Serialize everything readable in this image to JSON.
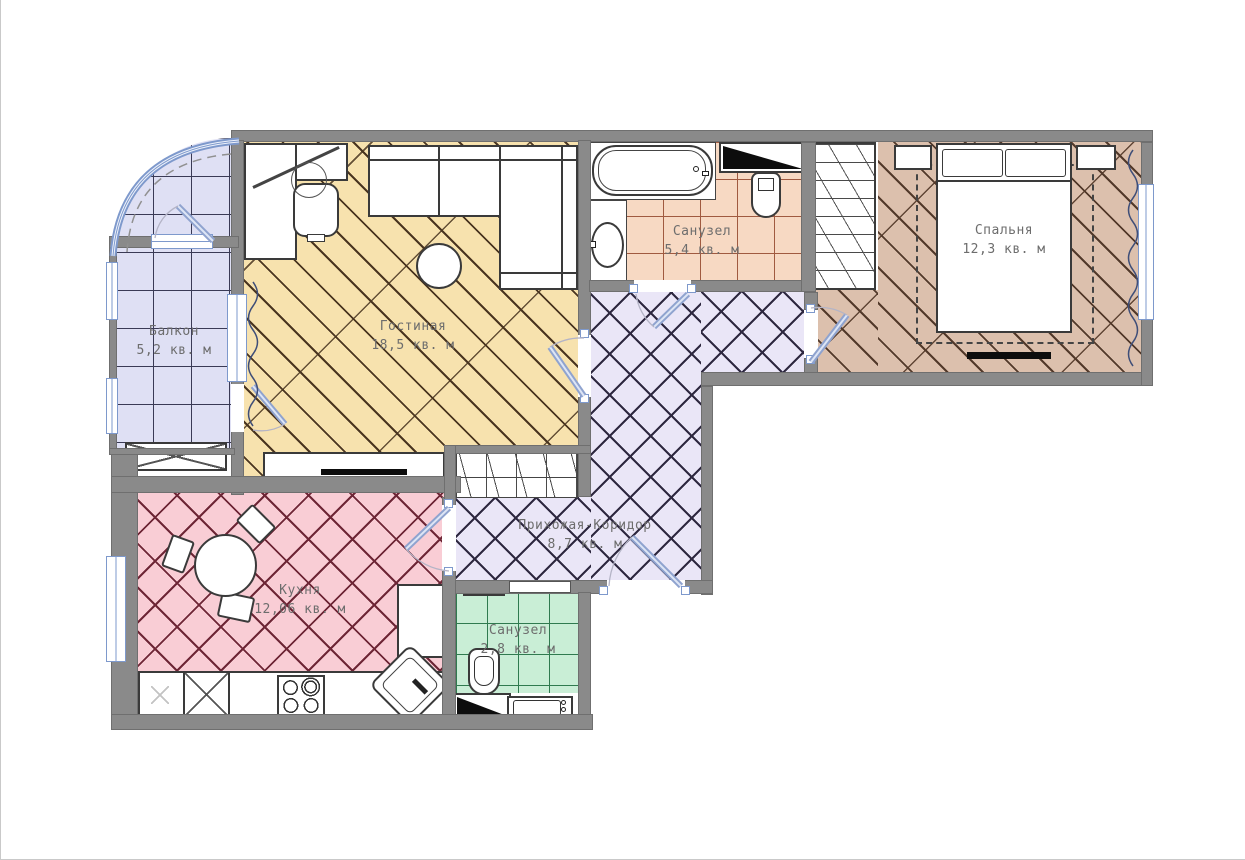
{
  "plan": {
    "rooms": {
      "balcony": {
        "name": "Балкон",
        "area": "5,2 кв. м"
      },
      "living_room": {
        "name": "Гостиная",
        "area": "18,5 кв. м"
      },
      "bathroom": {
        "name": "Санузел",
        "area": "5,4 кв. м"
      },
      "bedroom": {
        "name": "Спальня",
        "area": "12,3 кв. м"
      },
      "hallway": {
        "name": "Прихожая-Коридор",
        "area": "8,7 кв. м"
      },
      "kitchen": {
        "name": "Кухня",
        "area": "12,06 кв. м"
      },
      "wc": {
        "name": "Санузел",
        "area": "2,8 кв. м"
      }
    },
    "fixtures": [
      "bathtub",
      "washbasin",
      "toilet",
      "bed",
      "pillow",
      "nightstand",
      "wardrobe",
      "sofa",
      "coffee-table",
      "desk",
      "office-chair",
      "tv",
      "tv-stand",
      "dining-table",
      "chair",
      "kitchen-counter",
      "stove",
      "kitchen-sink",
      "fridge",
      "towel-rail",
      "vent-shaft",
      "entrance-door",
      "window",
      "carpet",
      "curtain",
      "storage-box"
    ],
    "colors": {
      "wall": "#8a8a8a",
      "balcony_floor": "#dfe0f4",
      "living_floor": "#f7e2ae",
      "bathroom_floor": "#f7d9c3",
      "bedroom_floor": "#dcc0ad",
      "hallway_floor": "#eae6f7",
      "kitchen_floor": "#f9cdd5",
      "wc_floor": "#c9eed6",
      "glazing": "#7e99cc",
      "door_leaf": "#8fa3cf",
      "vent": "#0d0d0d"
    }
  }
}
